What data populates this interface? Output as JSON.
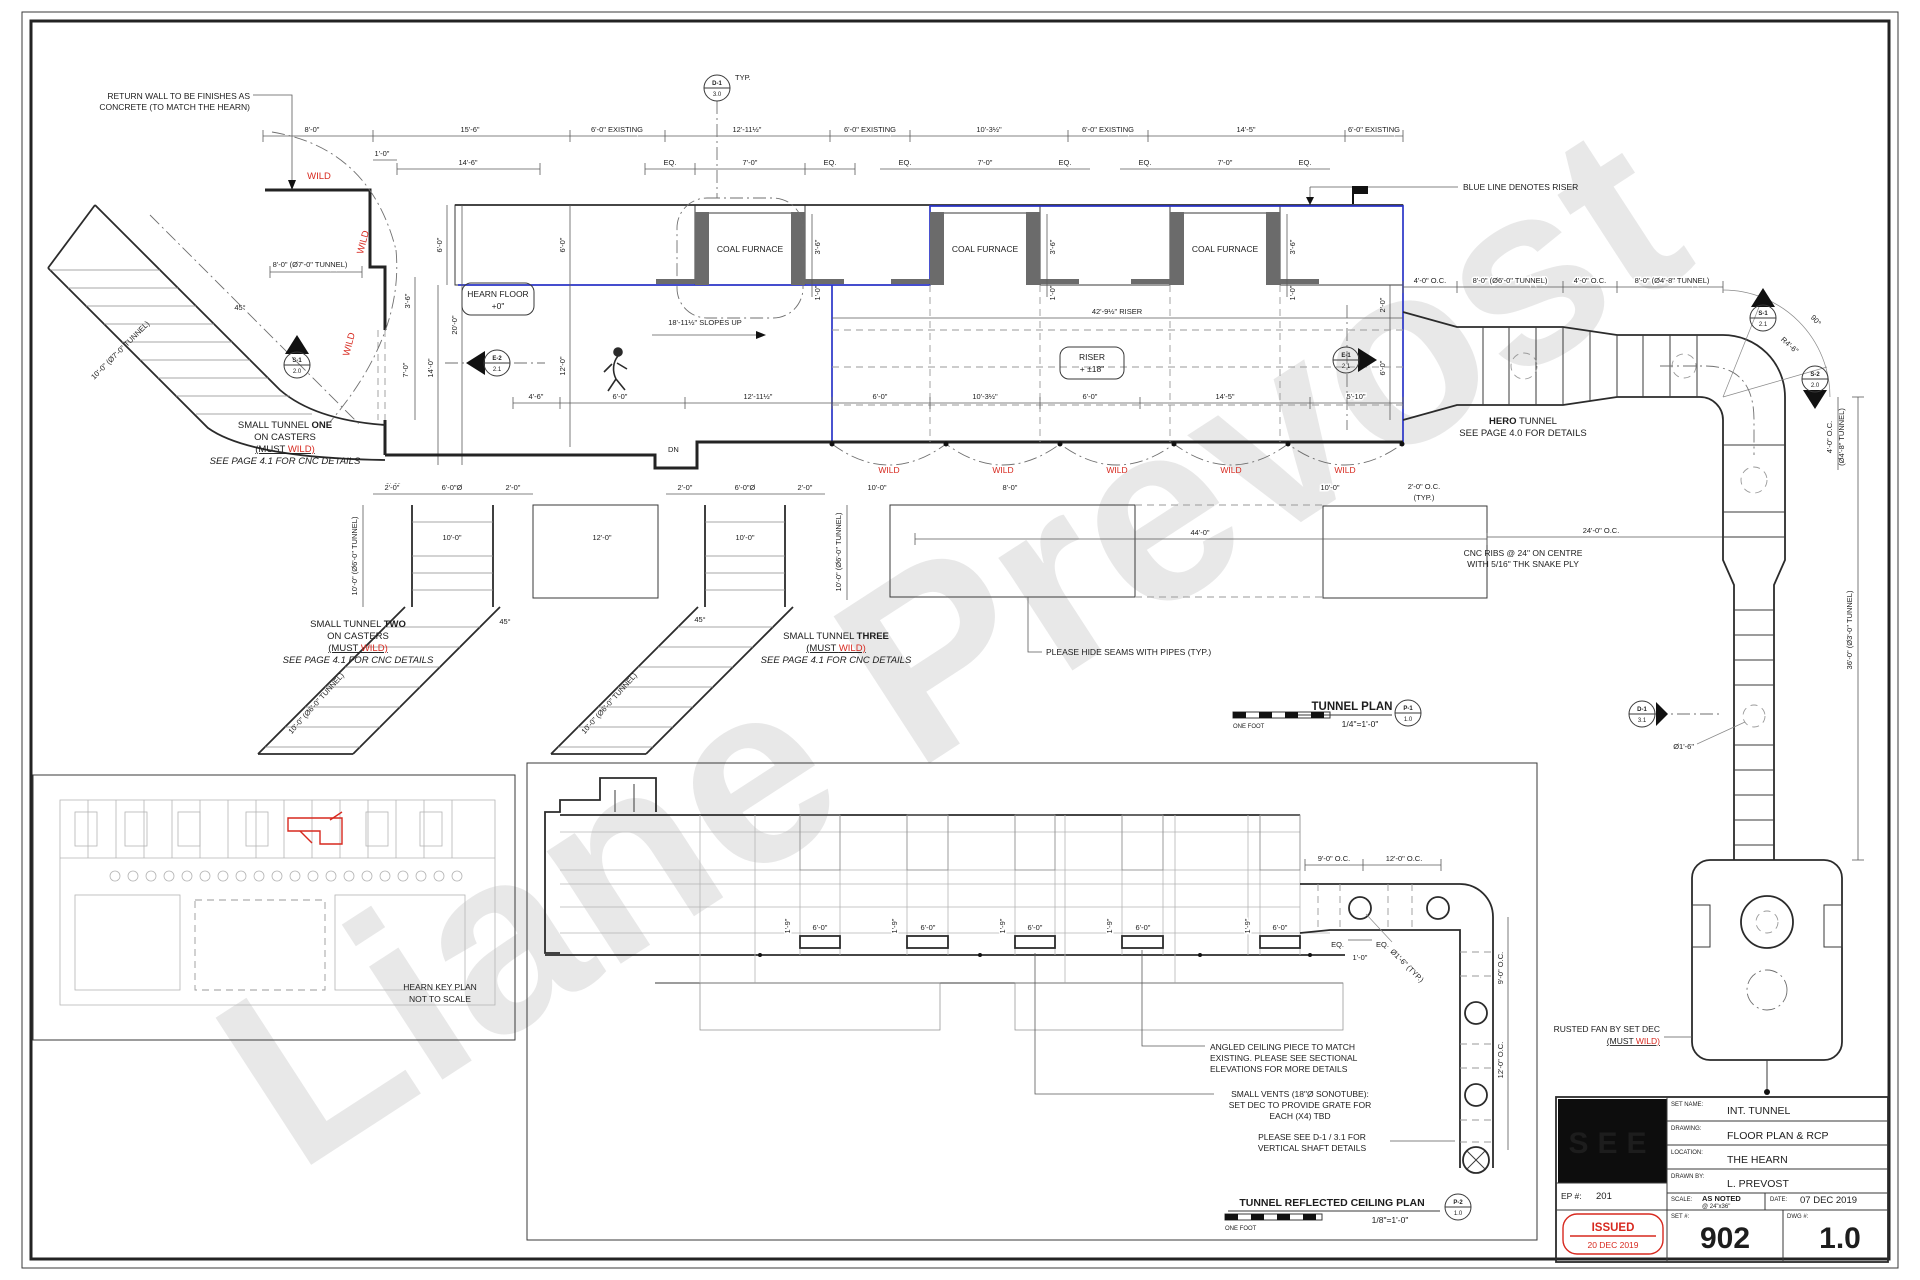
{
  "watermark": "Liane Prevost",
  "colors": {
    "riser_blue": "#2b35c8",
    "annotation_red": "#d7291f"
  },
  "plan": {
    "title": "TUNNEL PLAN",
    "scale": "1/4\"=1'-0\"",
    "scale_bar": "ONE FOOT",
    "furnace": "COAL FURNACE",
    "hearn_floor": {
      "l1": "HEARN FLOOR",
      "l2": "+0\""
    },
    "riser_box": {
      "l1": "RISER",
      "l2": "+ ±18\""
    },
    "slopes": "18'-11½\" SLOPES UP",
    "riser_dim": "42'-9½\" RISER",
    "dn": "DN",
    "typ": "TYP.",
    "wild": "WILD",
    "notes": {
      "return_wall": {
        "l1": "RETURN WALL TO BE FINISHES AS",
        "l2": "CONCRETE (TO MATCH THE HEARN)"
      },
      "blue_line": "BLUE LINE DENOTES RISER",
      "hero": {
        "b": "HERO",
        "l1": " TUNNEL",
        "l2": "SEE PAGE 4.0 FOR DETAILS"
      },
      "cnc": {
        "l1": "CNC RIBS @ 24\" ON CENTRE",
        "l2": "WITH 5/16\" THK SNAKE PLY"
      },
      "hide_seams": "PLEASE HIDE SEAMS WITH PIPES (TYP.)",
      "rusted_fan": "RUSTED FAN BY SET DEC",
      "must": "(MUST ",
      "wild_p": "WILD)",
      "t1": {
        "p": "SMALL TUNNEL ",
        "b": "ONE",
        "l2": "ON CASTERS",
        "l4": "SEE PAGE 4.1 FOR CNC DETAILS"
      },
      "t2b": "TWO",
      "t3b": "THREE"
    }
  },
  "dims": {
    "top": [
      "8'-0\"",
      "15'-6\"",
      "6'-0\" EXISTING",
      "12'-11½\"",
      "6'-0\" EXISTING",
      "10'-3½\"",
      "6'-0\" EXISTING",
      "14'-5\"",
      "6'-0\" EXISTING"
    ],
    "top2": [
      "14'-6\"",
      "EQ.",
      "7'-0\"",
      "EQ.",
      "1'-0\""
    ],
    "left": [
      "8'-0\" (Ø7'-0\" TUNNEL)",
      "10'-0\" (Ø7'-0\" TUNNEL)",
      "45°",
      "3'-6\"",
      "7'-0\"",
      "14'-0\"",
      "20'-0\"",
      "6'-0\"",
      "2'-0\""
    ],
    "band": [
      "6'-0\"",
      "6'-0\"",
      "12'-0\"",
      "3'-6\"",
      "1'-0\"",
      "2'-0\"",
      "6'-0\""
    ],
    "mid": [
      "4'-6\"",
      "6'-0\"",
      "12'-11½\"",
      "6'-0\"",
      "10'-3½\"",
      "6'-0\"",
      "14'-5\"",
      "5'-10\""
    ],
    "bottom": [
      "2'-0\"",
      "6'-0\"Ø",
      "2'-0\"",
      "10'-0\"",
      "12'-0\"",
      "10'-0\"",
      "8'-0\"",
      "10'-0\"",
      "44'-0\"",
      "24'-0\" O.C.",
      "2'-0\" O.C.",
      "(TYP.)",
      "45°"
    ],
    "shaft_label": "10'-0\" (Ø6'-0\" TUNNEL)",
    "hero": [
      "4'-0\" O.C.",
      "8'-0\" (Ø6'-0\" TUNNEL)",
      "4'-0\" O.C.",
      "8'-0\" (Ø4'-8\" TUNNEL)",
      "R4'-6\"",
      "90°",
      "4'-0\" O.C.",
      "(Ø4'-8\" TUNNEL)",
      "36'-0\" (Ø3'-0\" TUNNEL)",
      "Ø1'-6\""
    ],
    "rcp": [
      "9'-0\" O.C.",
      "12'-0\" O.C.",
      "1'-9\"",
      "6'-0\"",
      "EQ.",
      "EQ.",
      "1'-0\"",
      "Ø1'-6\" (TYP.)",
      "9'-0\" O.C.",
      "12'-0\" O.C."
    ]
  },
  "markers": [
    {
      "t": "D-1",
      "b": "3.0"
    },
    {
      "t": "S-1",
      "b": "2.0"
    },
    {
      "t": "E-2",
      "b": "2.1"
    },
    {
      "t": "E-1",
      "b": "2.1"
    },
    {
      "t": "S-1",
      "b": "2.1"
    },
    {
      "t": "S-2",
      "b": "2.0"
    },
    {
      "t": "D-1",
      "b": "3.1"
    },
    {
      "t": "P-1",
      "b": "1.0"
    },
    {
      "t": "P-2",
      "b": "1.0"
    }
  ],
  "rcp": {
    "title": "TUNNEL REFLECTED CEILING PLAN",
    "scale": "1/8\"=1'-0\"",
    "scale_bar": "ONE FOOT",
    "notes": {
      "angled": {
        "l1": "ANGLED CEILING PIECE TO MATCH",
        "l2": "EXISTING.  PLEASE SEE SECTIONAL",
        "l3": "ELEVATIONS FOR MORE DETAILS"
      },
      "vents": {
        "l1": "SMALL VENTS (18\"Ø SONOTUBE):",
        "l2": "SET DEC TO PROVIDE GRATE FOR",
        "l3": "EACH (X4) TBD"
      },
      "shaft": {
        "l1": "PLEASE SEE D-1 / 3.1 FOR",
        "l2": "VERTICAL SHAFT DETAILS"
      }
    }
  },
  "keyplan": {
    "l1": "HEARN KEY PLAN",
    "l2": "NOT TO SCALE"
  },
  "titleblock": {
    "logo": "SEE",
    "set_name_label": "SET NAME:",
    "set_name": "INT. TUNNEL",
    "drawing_label": "DRAWING:",
    "drawing": "FLOOR PLAN & RCP",
    "location_label": "LOCATION:",
    "location": "THE HEARN",
    "drawn_by_label": "DRAWN BY:",
    "drawn_by": "L. PREVOST",
    "scale_label": "SCALE:",
    "scale": "AS NOTED",
    "scale_sub": "@ 24\"x36\"",
    "date_label": "DATE:",
    "date": "07 DEC 2019",
    "ep_label": "EP #:",
    "ep": "201",
    "set_label": "SET #:",
    "set_no": "902",
    "dwg_label": "DWG #:",
    "dwg_no": "1.0",
    "stamp": "ISSUED",
    "stamp_date": "20 DEC 2019"
  }
}
